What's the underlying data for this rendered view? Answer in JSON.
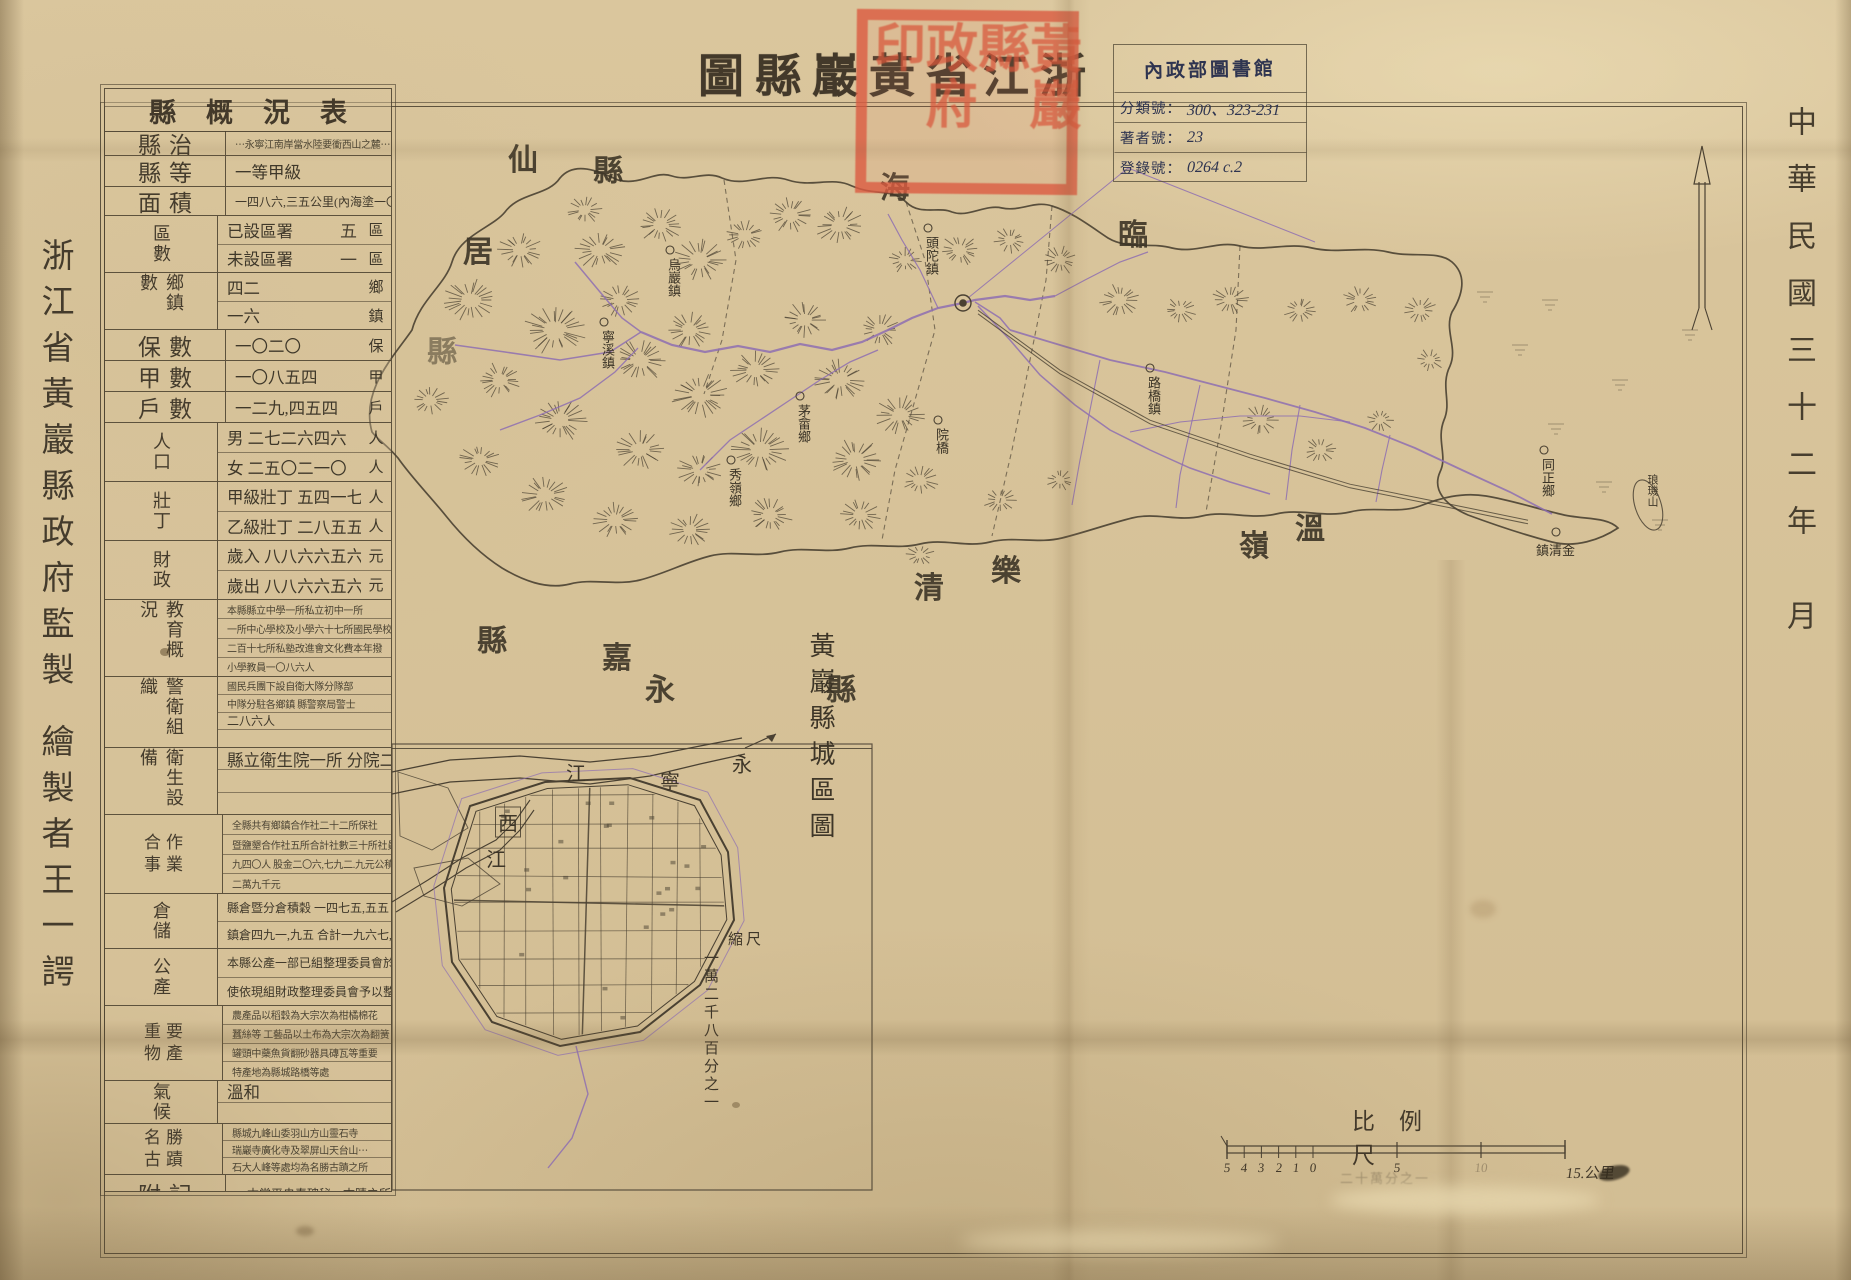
{
  "palette": {
    "paper": "#dac69d",
    "ink": "#4a4132",
    "purple": "#8e6fb2",
    "seal_red": "#d95f48",
    "stamp_ink": "#2e3450"
  },
  "title": {
    "text": "浙江省黃巖縣圖",
    "display": "圖縣巖黃省江浙"
  },
  "seal": {
    "text_right": "黃巖縣",
    "text_left": "政府印"
  },
  "library_stamp": {
    "title": "內政部圖書館",
    "fields": [
      {
        "label": "分類號",
        "value": "300、323-231"
      },
      {
        "label": "著者號",
        "value": "23"
      },
      {
        "label": "登錄號",
        "value": "0264 c.2"
      }
    ]
  },
  "margins": {
    "date": "中華民國三十二年",
    "date2": "月",
    "publisher": "浙江省黃巖縣政府監製",
    "author": "繪製者王一諤"
  },
  "overview_table": {
    "title_display": "縣概況表",
    "rows": [
      {
        "label": "縣治",
        "ll": "h",
        "lines": [
          {
            "t": "⋯永寧江南岸當水陸要衝西山之麓⋯",
            "cls": "t-tiny"
          }
        ]
      },
      {
        "label": "縣等",
        "ll": "h",
        "lines": [
          {
            "t": "一等甲級"
          }
        ]
      },
      {
        "label": "面積",
        "ll": "h",
        "lines": [
          {
            "t": "一四八六,三五公里(內海塗一〇五,一七)",
            "cls": "t-small"
          }
        ]
      },
      {
        "label": "區數",
        "ll": "v",
        "lines": [
          {
            "t": "已設區署",
            "v": "五",
            "u": "區"
          },
          {
            "t": "未設區署",
            "v": "一",
            "u": "區"
          }
        ]
      },
      {
        "label": "鄉鎮數",
        "ll": "v",
        "lines": [
          {
            "t": "四二",
            "u": "鄉"
          },
          {
            "t": "一六",
            "u": "鎮"
          }
        ]
      },
      {
        "label": "保數",
        "ll": "h",
        "lines": [
          {
            "t": "一〇二〇",
            "u": "保"
          }
        ]
      },
      {
        "label": "甲數",
        "ll": "h",
        "lines": [
          {
            "t": "一〇八五四",
            "u": "甲"
          }
        ]
      },
      {
        "label": "戶數",
        "ll": "h",
        "lines": [
          {
            "t": "一二九,四五四",
            "u": "戶"
          }
        ]
      },
      {
        "label": "人口",
        "ll": "v",
        "lines": [
          {
            "t": "男 二七二六四六",
            "u": "人"
          },
          {
            "t": "女 二五〇二一〇",
            "u": "人"
          }
        ]
      },
      {
        "label": "壯丁",
        "ll": "v",
        "lines": [
          {
            "t": "甲級壯丁 五四一七一",
            "u": "人"
          },
          {
            "t": "乙級壯丁 二八五五三",
            "u": "人"
          }
        ]
      },
      {
        "label": "財政",
        "ll": "v",
        "lines": [
          {
            "t": "歲入 八八六六五六〇",
            "u": "元"
          },
          {
            "t": "歲出 八八六六五六〇",
            "u": "元"
          }
        ]
      },
      {
        "label": "教育概況",
        "ll": "v",
        "lines": [
          {
            "t": "本縣縣立中學一所私立初中一所",
            "cls": "t-tiny"
          },
          {
            "t": "一所中心學校及小學六十七所國民學校",
            "cls": "t-tiny"
          },
          {
            "t": "二百十七所私塾改進會文化費本年撥",
            "cls": "t-tiny"
          },
          {
            "t": "小學教員一〇八六人",
            "cls": "t-tiny"
          }
        ]
      },
      {
        "label": "警衛組織",
        "ll": "v",
        "lines": [
          {
            "t": "國民兵團下設自衛大隊分隊部",
            "cls": "t-tiny"
          },
          {
            "t": "中隊分駐各鄉鎮 縣警察局警士",
            "cls": "t-tiny"
          },
          {
            "t": "二八六人",
            "cls": "t-small"
          },
          {
            "t": ""
          }
        ]
      },
      {
        "label": "衛生設備",
        "ll": "v",
        "lines": [
          {
            "t": "縣立衛生院一所 分院二所"
          },
          {
            "t": ""
          },
          {
            "t": ""
          }
        ]
      },
      {
        "label": "合作事業",
        "ll": "g",
        "lines": [
          {
            "t": "全縣共有鄉鎮合作社二十二所保社",
            "cls": "t-tiny"
          },
          {
            "t": "暨鹽墾合作社五所合計社數三十所社員一",
            "cls": "t-tiny"
          },
          {
            "t": "九四〇人 股金二〇六,七九二.九元公積金",
            "cls": "t-tiny"
          },
          {
            "t": "二萬九千元",
            "cls": "t-tiny"
          }
        ]
      },
      {
        "label": "倉儲",
        "ll": "v",
        "lines": [
          {
            "t": "縣倉暨分倉積穀 一四七五,五五",
            "cls": "t-small"
          },
          {
            "t": "鎮倉四九一,九五 合計一九六七,五〇",
            "cls": "t-small"
          }
        ]
      },
      {
        "label": "公產",
        "ll": "v",
        "lines": [
          {
            "t": "本縣公產一部已組整理委員會於四年",
            "cls": "t-small"
          },
          {
            "t": "使依現組財政整理委員會予以整理",
            "cls": "t-small"
          }
        ]
      },
      {
        "label": "重要物產",
        "ll": "g",
        "lines": [
          {
            "t": "農產品以稻穀為大宗次為柑橘棉花",
            "cls": "t-tiny"
          },
          {
            "t": "蠶絲等 工藝品以土布為大宗次為翻簧",
            "cls": "t-tiny"
          },
          {
            "t": "罐頭中藥魚貨翻砂器具磚瓦等重要",
            "cls": "t-tiny"
          },
          {
            "t": "特產地為縣城路橋等處",
            "cls": "t-tiny"
          }
        ]
      },
      {
        "label": "氣候",
        "ll": "v",
        "lines": [
          {
            "t": "溫和"
          },
          {
            "t": ""
          }
        ]
      },
      {
        "label": "名勝古蹟",
        "ll": "g",
        "lines": [
          {
            "t": "縣城九峰山委羽山方山靈石寺",
            "cls": "t-tiny"
          },
          {
            "t": "瑞巖寺廣化寺及翠屏山天台山⋯",
            "cls": "t-tiny"
          },
          {
            "t": "石大人峰等處均為名勝古蹟之所",
            "cls": "t-tiny"
          }
        ]
      },
      {
        "label": "附記",
        "ll": "h",
        "lines": [
          {
            "t": "⋯本常平央春碑秘⋯古蹟之所",
            "cls": "t-small"
          }
        ]
      }
    ]
  },
  "map": {
    "neighbor_chars": [
      {
        "ch": "臨",
        "x": 1133,
        "y": 232
      },
      {
        "ch": "海",
        "x": 895,
        "y": 185
      },
      {
        "ch": "縣",
        "x": 608,
        "y": 168
      },
      {
        "ch": "仙",
        "x": 523,
        "y": 157
      },
      {
        "ch": "居",
        "x": 478,
        "y": 249
      },
      {
        "ch": "縣",
        "x": 442,
        "y": 349,
        "faint": true
      },
      {
        "ch": "永",
        "x": 660,
        "y": 687
      },
      {
        "ch": "嘉",
        "x": 617,
        "y": 655
      },
      {
        "ch": "縣",
        "x": 492,
        "y": 638
      },
      {
        "ch": "樂",
        "x": 1006,
        "y": 568
      },
      {
        "ch": "清",
        "x": 929,
        "y": 585
      },
      {
        "ch": "縣",
        "x": 841,
        "y": 687
      },
      {
        "ch": "溫",
        "x": 1310,
        "y": 526
      },
      {
        "ch": "嶺",
        "x": 1254,
        "y": 543
      }
    ],
    "towns": [
      {
        "t": "烏巖鎮",
        "x": 664,
        "y": 258,
        "vert": true
      },
      {
        "t": "寧溪鎮",
        "x": 598,
        "y": 330,
        "vert": true
      },
      {
        "t": "頭陀鎮",
        "x": 922,
        "y": 236,
        "vert": true
      },
      {
        "t": "院橋",
        "x": 932,
        "y": 428,
        "vert": true
      },
      {
        "t": "路橋鎮",
        "x": 1144,
        "y": 376,
        "vert": true
      },
      {
        "t": "金清鎮",
        "x": 1536,
        "y": 540,
        "rtl": true
      },
      {
        "t": "同正鄉",
        "x": 1538,
        "y": 458,
        "vert": true
      },
      {
        "t": "茅畲鄉",
        "x": 794,
        "y": 404,
        "vert": true
      },
      {
        "t": "秀嶺鄉",
        "x": 725,
        "y": 468,
        "vert": true
      }
    ],
    "island_label": "琅璣山"
  },
  "inset": {
    "title": "黃巖縣城區圖",
    "river_chars": [
      {
        "ch": "永",
        "x": 742,
        "y": 763
      },
      {
        "ch": "寧",
        "x": 670,
        "y": 780
      },
      {
        "ch": "江",
        "x": 576,
        "y": 772
      }
    ],
    "west_river_chars": [
      {
        "ch": "西",
        "x": 508,
        "y": 822,
        "boxed": true
      },
      {
        "ch": "江",
        "x": 496,
        "y": 858
      }
    ],
    "scale_label": "縮尺",
    "scale_value": "一萬二千八百分之一"
  },
  "scalebar": {
    "label": "比例尺",
    "sub_ticks": [
      "5",
      "4",
      "3",
      "2",
      "1",
      "0"
    ],
    "mid_tick": "5",
    "ten_tick": "10",
    "end_label": "15.公里",
    "note": "二十萬分之一"
  }
}
